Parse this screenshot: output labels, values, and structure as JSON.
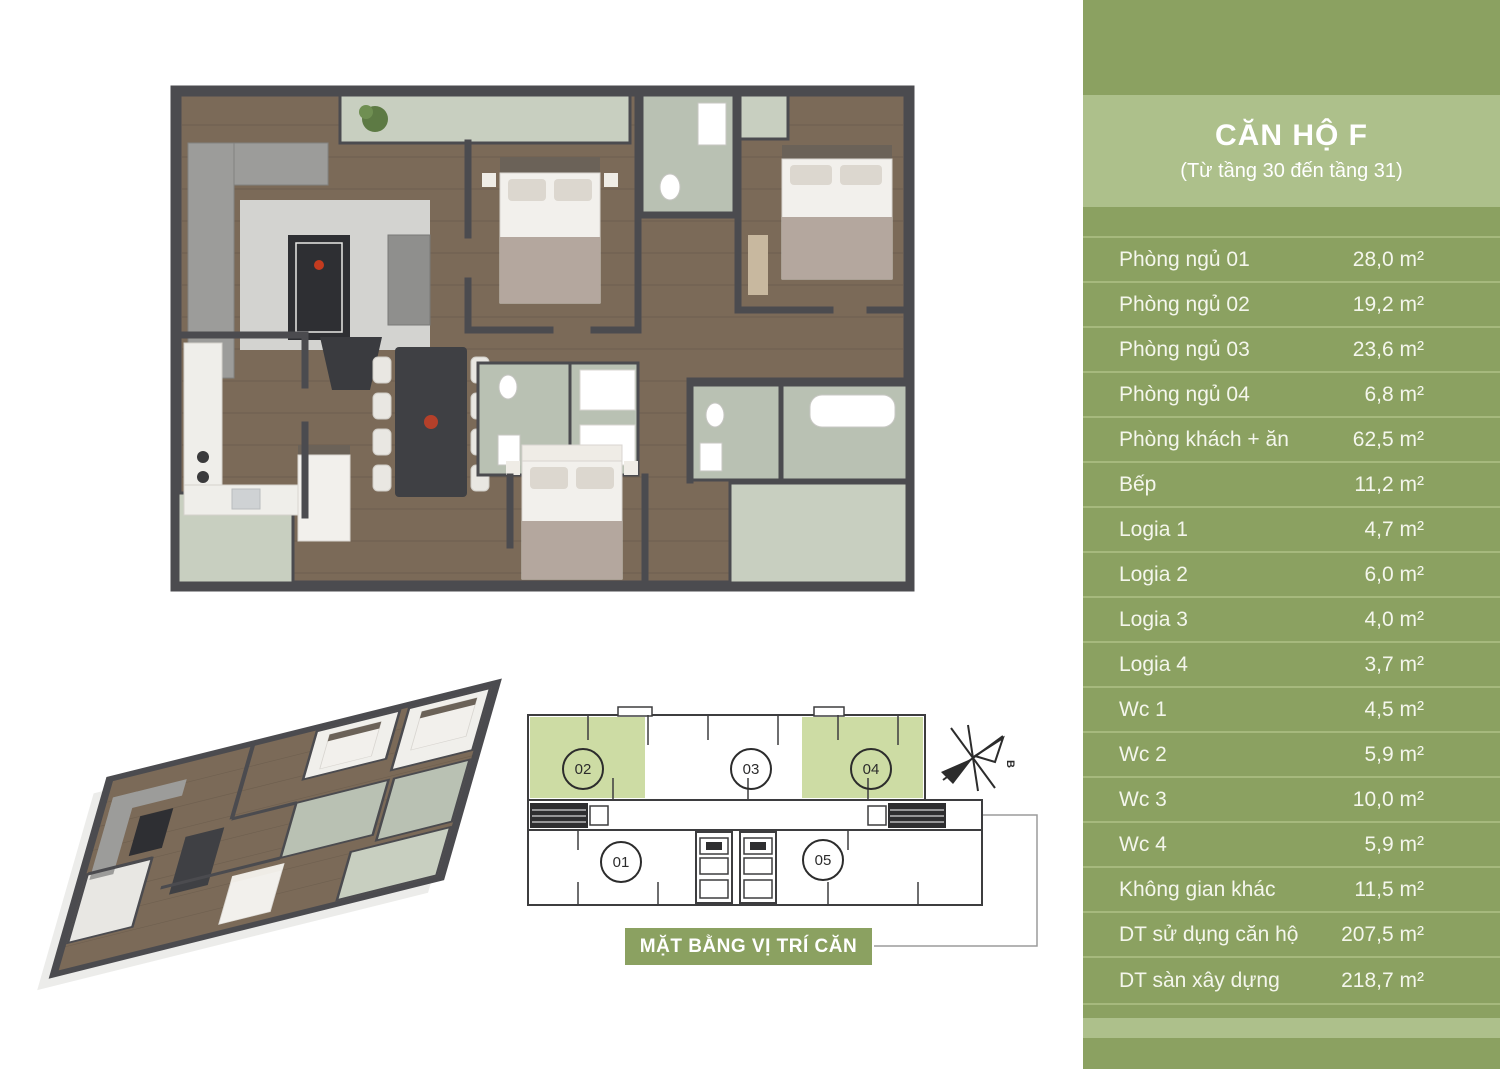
{
  "panel": {
    "title": "CĂN HỘ F",
    "subtitle": "(Từ tầng 30 đến tầng 31)",
    "rows": [
      {
        "label": "Phòng ngủ 01",
        "area": "28,0 m²"
      },
      {
        "label": "Phòng ngủ 02",
        "area": "19,2 m²"
      },
      {
        "label": "Phòng ngủ 03",
        "area": "23,6 m²"
      },
      {
        "label": "Phòng ngủ 04",
        "area": "6,8 m²"
      },
      {
        "label": "Phòng khách + ăn",
        "area": "62,5 m²"
      },
      {
        "label": "Bếp",
        "area": "11,2 m²"
      },
      {
        "label": "Logia 1",
        "area": "4,7 m²"
      },
      {
        "label": "Logia 2",
        "area": "6,0 m²"
      },
      {
        "label": "Logia 3",
        "area": "4,0 m²"
      },
      {
        "label": "Logia 4",
        "area": "3,7 m²"
      },
      {
        "label": "Wc 1",
        "area": "4,5 m²"
      },
      {
        "label": "Wc 2",
        "area": "5,9 m²"
      },
      {
        "label": "Wc 3",
        "area": "10,0 m²"
      },
      {
        "label": "Wc 4",
        "area": "5,9 m²"
      },
      {
        "label": "Không gian khác",
        "area": "11,5 m²"
      },
      {
        "label": "DT sử dụng căn hộ",
        "area": "207,5 m²"
      },
      {
        "label": "DT sàn xây dựng",
        "area": "218,7 m²"
      }
    ]
  },
  "location_plan": {
    "caption": "MẶT BẰNG VỊ TRÍ CĂN HỘ F",
    "compass_label": "B",
    "units": [
      {
        "number": "02",
        "highlighted": true
      },
      {
        "number": "03",
        "highlighted": false
      },
      {
        "number": "04",
        "highlighted": true
      },
      {
        "number": "01",
        "highlighted": false
      },
      {
        "number": "05",
        "highlighted": false
      }
    ]
  },
  "colors": {
    "panel_green": "#8ba161",
    "panel_light_green": "#adc08b",
    "row_separator": "#a6b97d",
    "unit_highlight_green": "#cddca4",
    "text_white": "#f4f6ec"
  }
}
